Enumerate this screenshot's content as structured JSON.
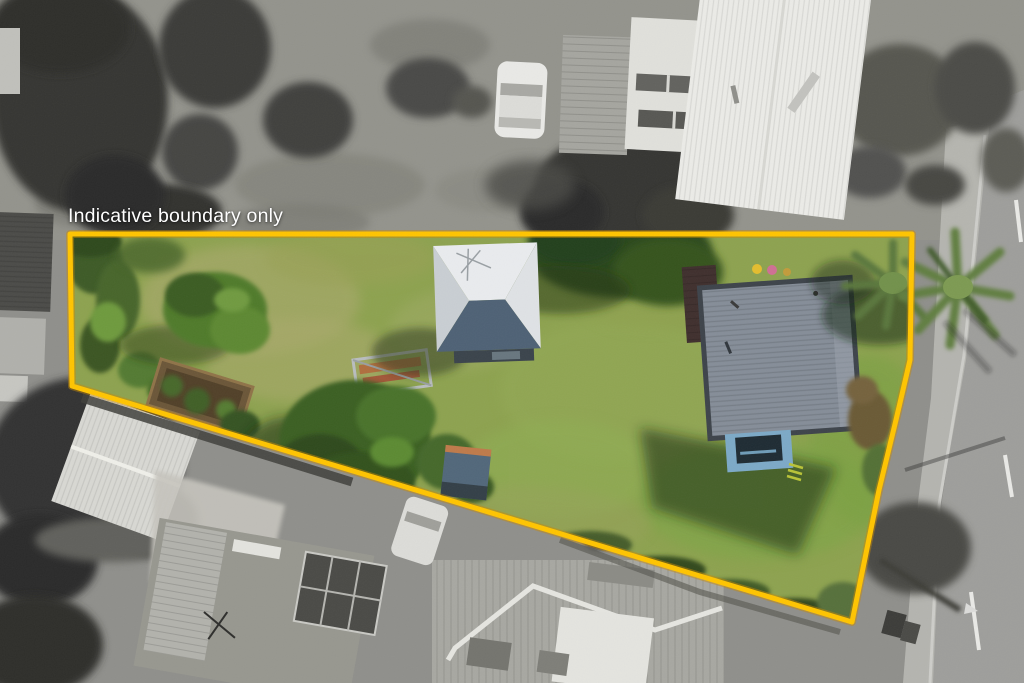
{
  "overlay": {
    "boundary_label": "Indicative boundary only",
    "label_color": "#ffffff"
  },
  "boundary": {
    "color": "#ffc400",
    "underglow_color": "#c98a00",
    "stroke_width": "5",
    "points": "70,234 912,234 910,360 896,420 879,490 852,622 72,386"
  },
  "palette": {
    "gray_ground": "#8f8f8b",
    "gray_top_lawn": "#93938c",
    "road": "#9e9e9b",
    "footpath": "#b6b6b1",
    "white_roof": "#ebebe7",
    "clerestory_roof": "#e0e0db",
    "gable_shed_roof": "#d8d8d3",
    "lawn": "#8da24f",
    "garage_roof": "#e9ebee",
    "garage_front": "#4e6175",
    "house_roof": "#858d98",
    "house_roof_border": "#3d434a",
    "deck_blue": "#7ca9c7",
    "teal_shed_roof": "#51677a",
    "teal_shed_ridge": "#bf7a4a"
  }
}
